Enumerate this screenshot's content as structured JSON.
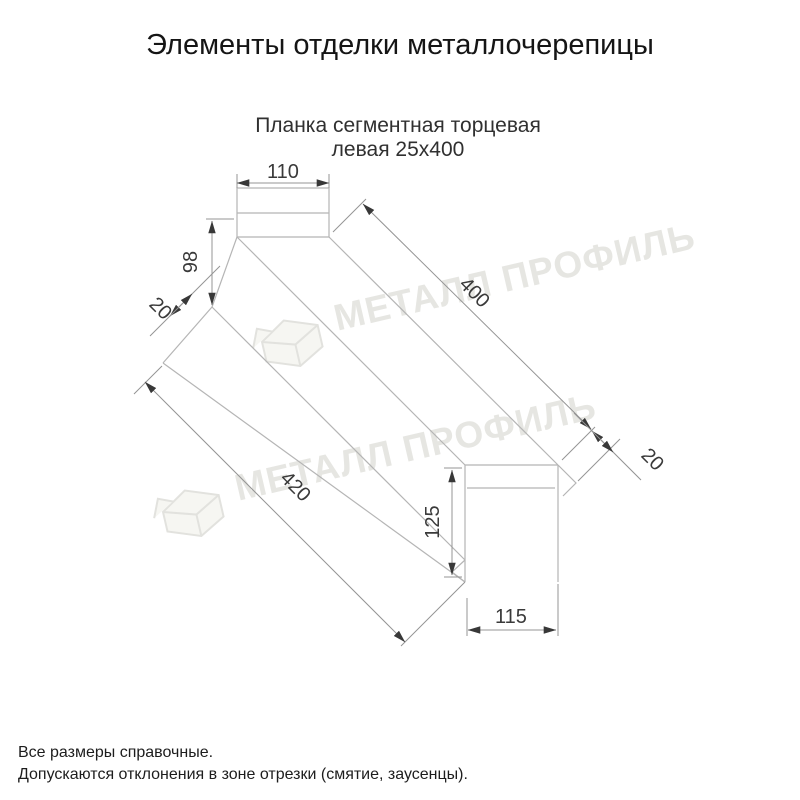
{
  "page": {
    "title": "Элементы отделки металлочерепицы"
  },
  "drawing": {
    "subtitle_line1": "Планка сегментная торцевая",
    "subtitle_line2": "левая 25х400",
    "dimensions": {
      "top_width": "110",
      "left_height": "98",
      "left_fold": "20",
      "top_length": "400",
      "right_fold": "20",
      "bottom_length": "420",
      "end_height": "125",
      "end_width": "115"
    },
    "watermark_text": "МЕТАЛЛ ПРОФИЛЬ",
    "line_color": "#b5b5b5",
    "dimension_color": "#949494",
    "text_color": "#3a3a3a",
    "watermark_color": "#e6e6e2"
  },
  "footer": {
    "line1": "Все размеры справочные.",
    "line2": "Допускаются отклонения в зоне отрезки (смятие, заусенцы)."
  }
}
